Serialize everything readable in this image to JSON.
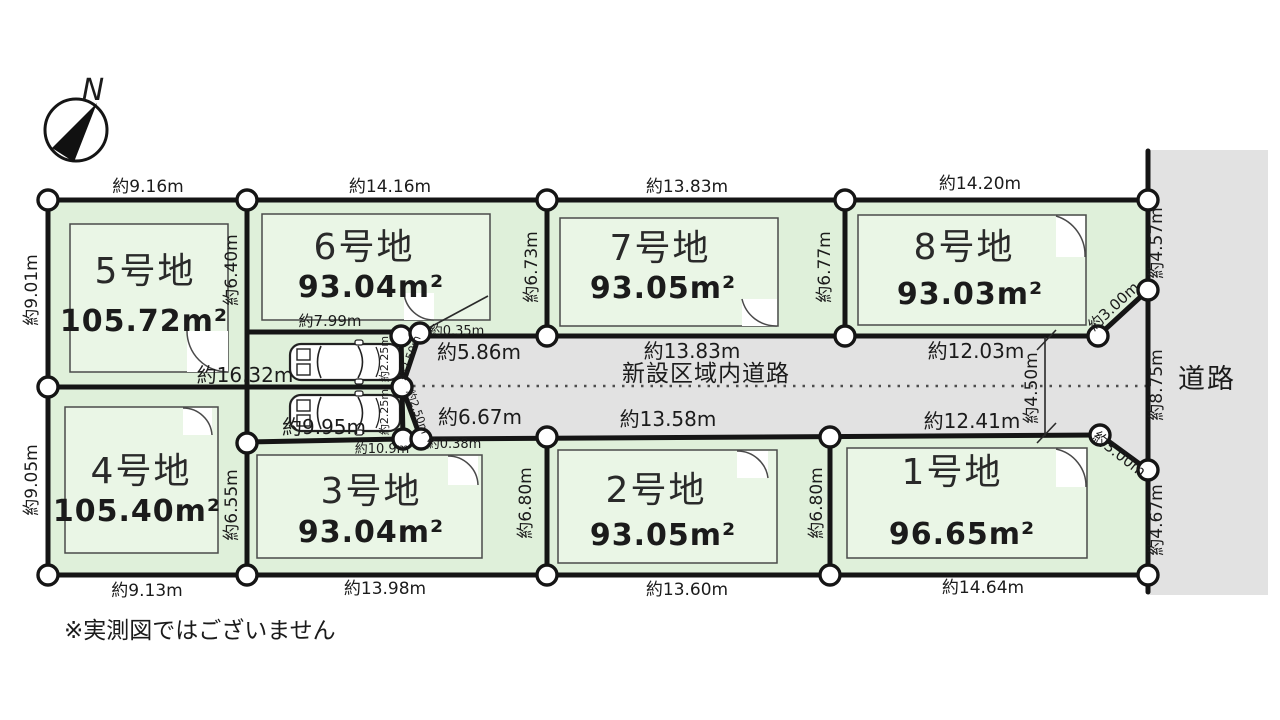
{
  "colors": {
    "plot_fill": "#dff0da",
    "building_fill": "#eaf6e6",
    "road_fill": "#e2e2e2",
    "line": "#151515"
  },
  "compass": {
    "north": "N"
  },
  "note": "※実測図ではございません",
  "roads": {
    "internal": "新設区域内道路",
    "east": "道路"
  },
  "plots": [
    {
      "name": "1号地",
      "area": "96.65m²"
    },
    {
      "name": "2号地",
      "area": "93.05m²"
    },
    {
      "name": "3号地",
      "area": "93.04m²"
    },
    {
      "name": "4号地",
      "area": "105.40m²"
    },
    {
      "name": "5号地",
      "area": "105.72m²"
    },
    {
      "name": "6号地",
      "area": "93.04m²"
    },
    {
      "name": "7号地",
      "area": "93.05m²"
    },
    {
      "name": "8号地",
      "area": "93.03m²"
    }
  ],
  "dims": {
    "top": [
      "約9.16m",
      "約14.16m",
      "約13.83m",
      "約14.20m"
    ],
    "bottom": [
      "約9.13m",
      "約13.98m",
      "約13.60m",
      "約14.64m"
    ],
    "left": [
      "約9.01m",
      "約9.05m"
    ],
    "right": [
      "約4.57m",
      "約8.75m",
      "約4.67m"
    ],
    "road_top": [
      "約5.86m",
      "約13.83m",
      "約12.03m"
    ],
    "road_bottom": [
      "約6.67m",
      "約13.58m",
      "約12.41m"
    ],
    "road_width": "約4.50m",
    "chamfer_top": "約3.00m",
    "chamfer_bottom": "約3.00m",
    "inner_left_top": "約6.40m",
    "inner_left_bottom": "約6.55m",
    "inner_mid_top": "約6.73m",
    "inner_mid_bottom": "約6.80m",
    "inner_right_top": "約6.77m",
    "inner_right_bottom": "約6.80m",
    "strip_top": "約7.99m",
    "strip_mid": "約16.32m",
    "strip_bottom": "約9.95m",
    "plot3_top": "約10.9m",
    "step_top": "約0.35m",
    "step_bottom": "約0.38m",
    "junction_v_top": "約2.25m",
    "junction_v_bottom": "約2.25m",
    "junction_d_top": "約2.50m",
    "junction_d_bottom": "約2.50m"
  }
}
